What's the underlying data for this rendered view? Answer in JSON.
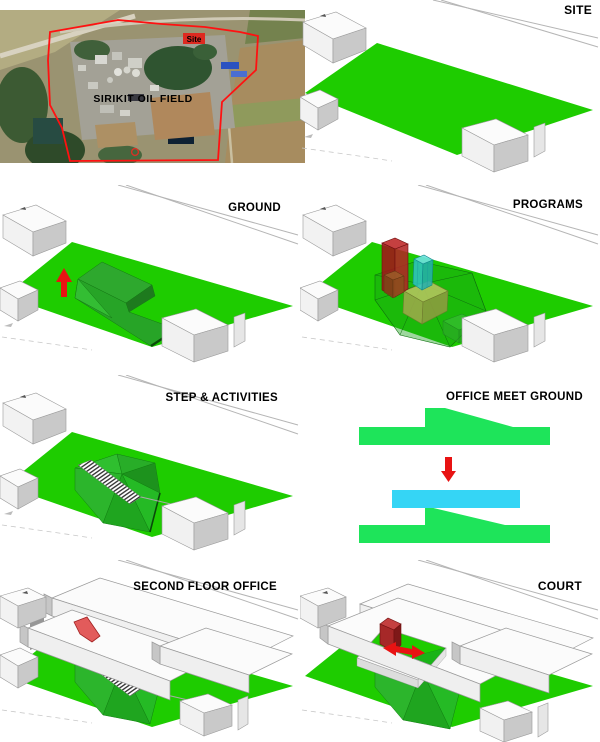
{
  "page": {
    "width": 600,
    "height": 742,
    "background": "#ffffff"
  },
  "colors": {
    "site_green": "#1ECC00",
    "landform_green_mid": "#2EA82E",
    "landform_green_dark": "#1E7A1E",
    "diagram_green": "#1EE45A",
    "office_cyan": "#35D5F5",
    "arrow_red": "#E81313",
    "program_red": "#A01818",
    "program_cyan": "#2FC4C4",
    "program_olive": "#9AAA48",
    "boundary_red": "#FF1111",
    "building_white": "#FBFBFB",
    "building_side_gray": "#C9C9C9"
  },
  "satellite": {
    "field_label": "SIRIKIT OIL FIELD",
    "site_marker_label": "Site"
  },
  "panels": {
    "site": {
      "label": "SITE"
    },
    "ground": {
      "label": "GROUND"
    },
    "programs": {
      "label": "PROGRAMS"
    },
    "step_activities": {
      "label": "STEP & ACTIVITIES"
    },
    "office_meet_ground": {
      "label": "OFFICE MEET GROUND"
    },
    "second_floor_office": {
      "label": "SECOND FLOOR OFFICE"
    },
    "court": {
      "label": "COURT"
    }
  }
}
